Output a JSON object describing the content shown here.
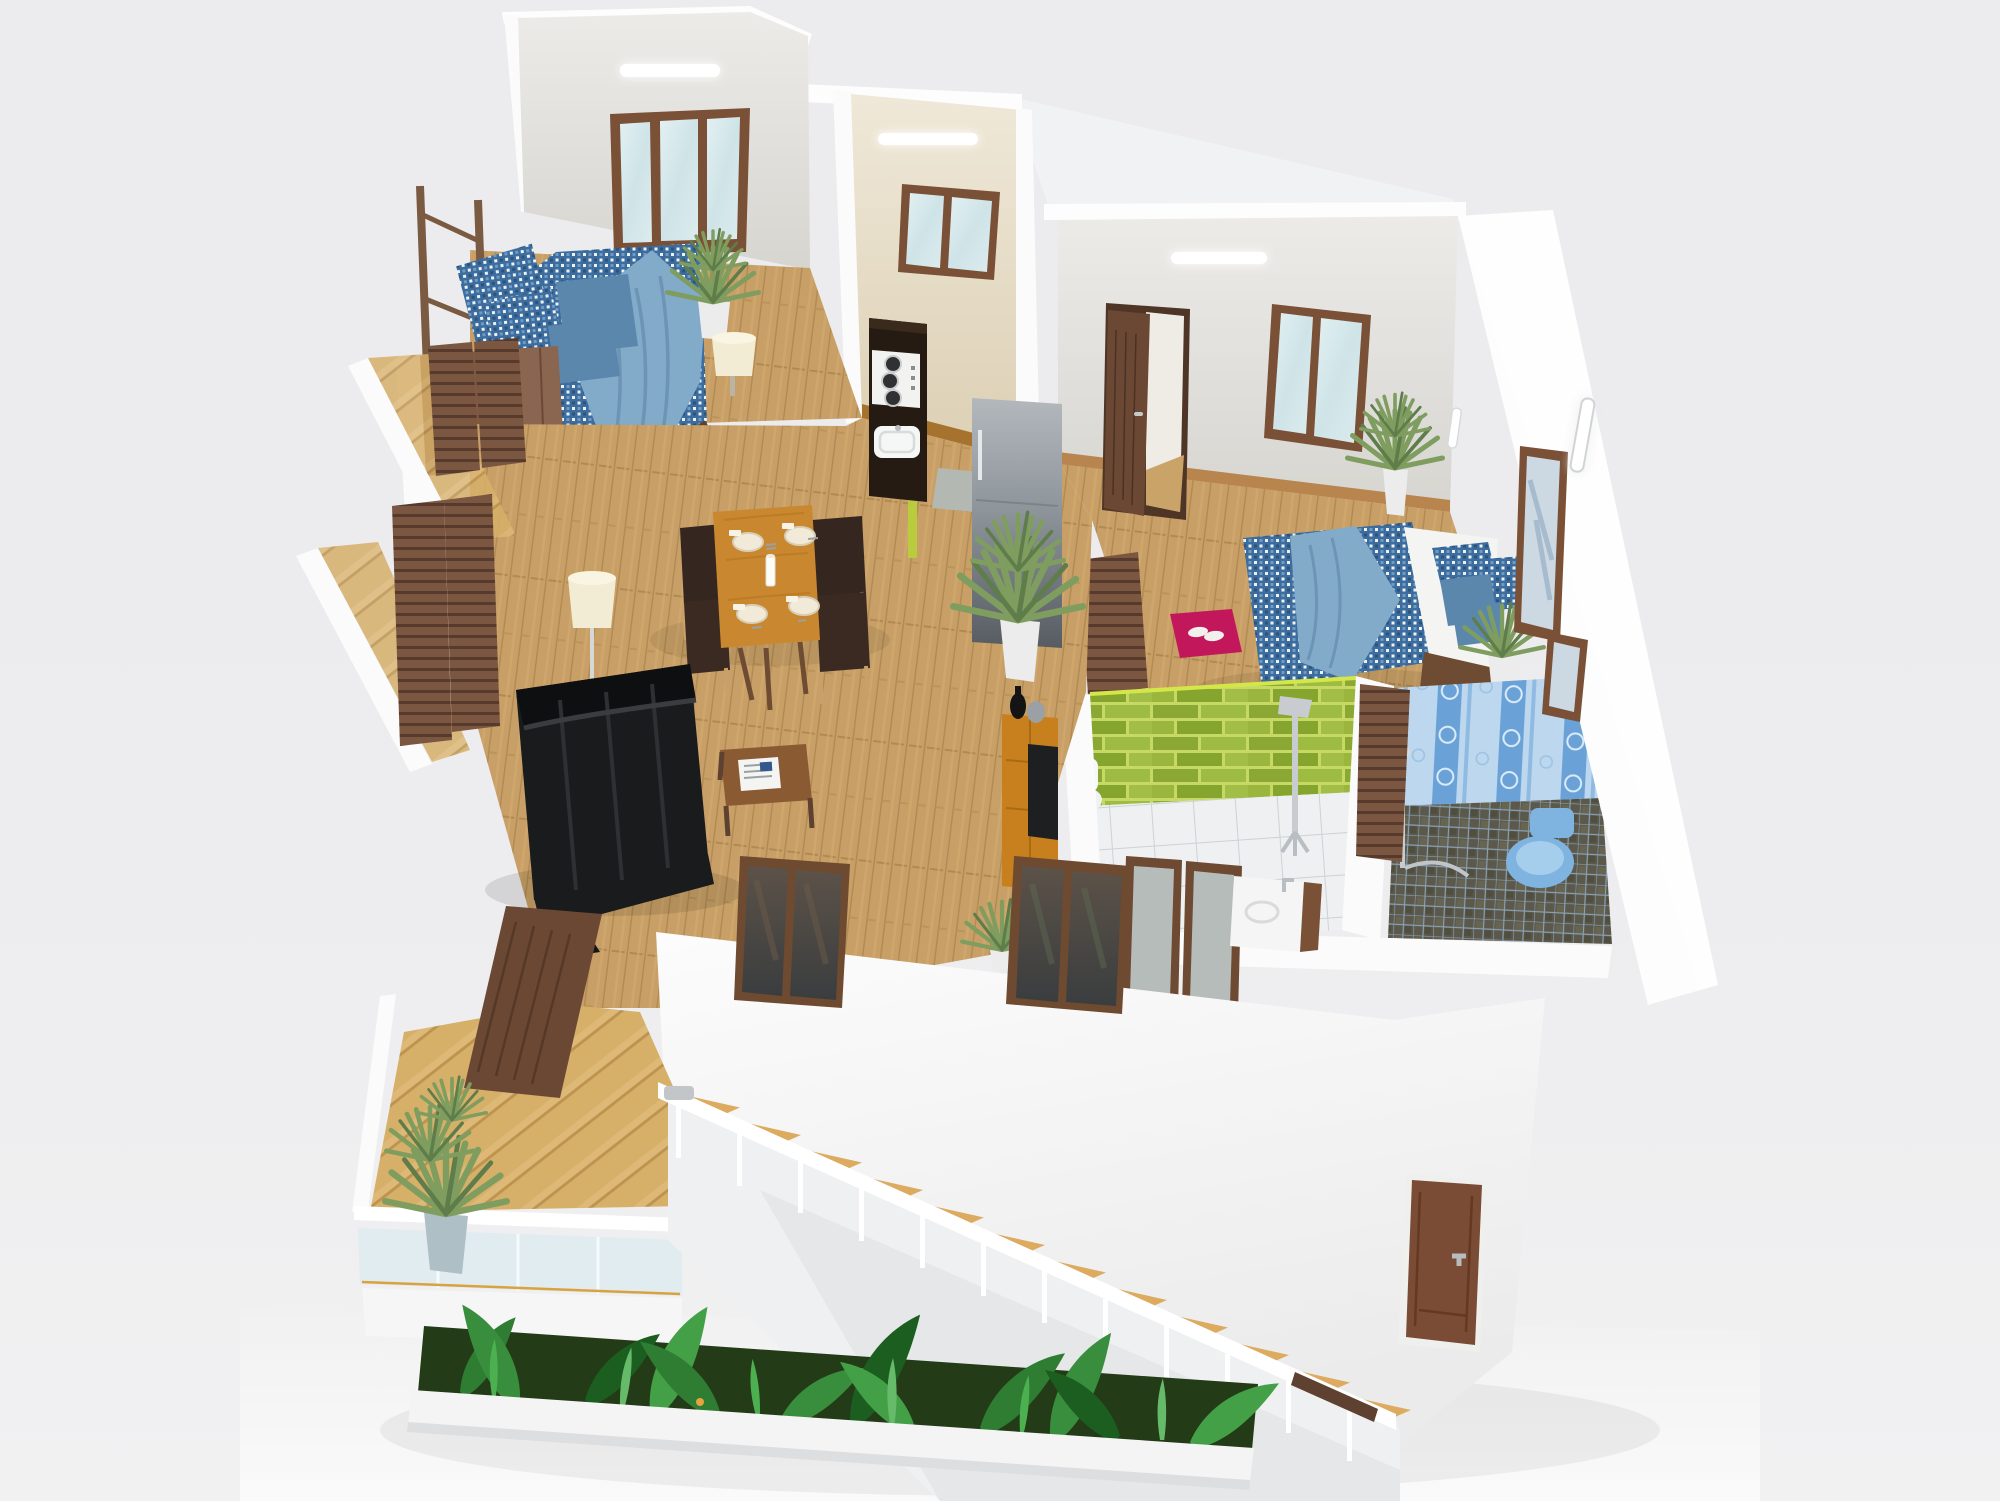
{
  "scene": {
    "type": "3d-isometric-floor-plan-render",
    "description": "Cutaway 3D rendering of a two-bedroom apartment viewed from above at an angle, with an exterior staircase and planter garden below the terrace",
    "view": "isometric cutaway from upper left",
    "visible_text": "none"
  },
  "palette": {
    "background": "#ededef",
    "ground": "#f7f7f8",
    "wall_white": "#fbfbfb",
    "wall_light": "#e9e8e4",
    "wall_shadow": "#d8d7d2",
    "wall_warm": "#e9e2cf",
    "wood_frame": "#7a5136",
    "door_interior": "#6b4833",
    "door_entry": "#7a4b35",
    "wood_dark": "#5e4130",
    "partition_brown": "#7b5640",
    "floor_wood": "#c8a067",
    "floor_parquet": "#d9b46f",
    "stair_wood": "#dcab60",
    "glass_light": "#d6e9ee",
    "glass_dark": "#474a4c",
    "bed_blue": "#3c6d9e",
    "bed_blue_light": "#82aac9",
    "pillow_blue": "#5b87ad",
    "mattress_white": "#f4f4f2",
    "green_tile": "#93b13a",
    "green_tile_edge": "#d4e74a",
    "bath_floor_white": "#eef0f1",
    "blue_tile_light": "#bcd7ee",
    "blue_tile_stripe": "#6aa2d8",
    "mosaic_dark": "#5b594b",
    "toilet_blue": "#7fb3e0",
    "rug_magenta": "#c2185b",
    "rug_purple": "#38293c",
    "sofa_black": "#1a1b1d",
    "console_orange": "#c8801f",
    "table_wood": "#c9882f",
    "lamp_cream": "#f3ecd4",
    "plant_green": "#7f9d5f",
    "foliage_dark": "#2e7d32",
    "chrome": "#c8ccd0",
    "counter_dark": "#261b12",
    "fridge_gray": "#9aa0a6",
    "light_white": "#ffffff"
  },
  "counts": {
    "dining_chairs": 4,
    "place_settings": 4,
    "gas_burners": 3,
    "stair_treads": 12,
    "stair_balusters": 12,
    "windows_visible": 7,
    "ceiling_strip_lights": 3
  },
  "rooms": [
    {
      "id": "bedroom-1",
      "label": "Bedroom 1 (upper left)",
      "objects": [
        "double bed with blue patterned duvet and light blue throw",
        "blue pillows",
        "potted plant in white vase",
        "cream table lamp",
        "dark purple rug",
        "wooden wardrobe bench",
        "triple-pane wooden window",
        "ceiling strip light",
        "wooden balcony railing"
      ]
    },
    {
      "id": "kitchen",
      "label": "Kitchen (center top)",
      "objects": [
        "dark counter with 3-burner gas hob",
        "white kitchen sink",
        "stainless refrigerator",
        "double-pane wooden window",
        "ceiling strip light",
        "tall palm plant in white pot",
        "gray doormat"
      ]
    },
    {
      "id": "bedroom-2",
      "label": "Bedroom 2 (right)",
      "objects": [
        "double bed with white mattress and blue duvet",
        "blue pillows",
        "open wooden interior door",
        "tilted double-pane window",
        "magenta rug with white slippers",
        "corner plant in tall white vase",
        "bedside plant",
        "wooden partitions",
        "framed wall panels",
        "wall tube light",
        "ceiling strip light"
      ]
    },
    {
      "id": "shower-room-green",
      "label": "Green tiled shower room",
      "objects": [
        "lime green brick tile walls",
        "white tiled floor",
        "chrome shower column",
        "white toilet",
        "framed glass doors"
      ]
    },
    {
      "id": "bathroom-blue",
      "label": "Blue bathroom",
      "objects": [
        "blue patterned tile walls",
        "dark mosaic tile floor",
        "wall-hung blue toilet",
        "chrome shower set",
        "white sink counter with faucet"
      ]
    },
    {
      "id": "living-room",
      "label": "Living room",
      "objects": [
        "black leather sofa",
        "wooden coffee table with newspaper",
        "cream tripod floor lamp",
        "orange wood TV sideboard",
        "flat TV",
        "decorative vases",
        "potted plant",
        "wooden slat screens"
      ]
    },
    {
      "id": "dining-area",
      "label": "Dining area",
      "objects": [
        "wooden dining table set for four",
        "four plates with cutlery and napkins",
        "white candle",
        "four dark wooden chairs"
      ]
    },
    {
      "id": "balcony-terrace",
      "label": "Balcony terrace (lower left)",
      "objects": [
        "herringbone parquet floor",
        "glass railing with white frame",
        "two yucca plants in pots",
        "open wooden balcony door"
      ]
    },
    {
      "id": "staircase",
      "label": "Exterior staircase",
      "objects": [
        "wooden treads",
        "white railing with balusters",
        "brown handrail accent"
      ]
    },
    {
      "id": "garden-planter",
      "label": "Garden planter strip",
      "objects": [
        "tropical banana leaves",
        "grasses",
        "small yellow and orange flowers",
        "white planter ledge"
      ]
    },
    {
      "id": "exterior",
      "label": "Exterior shell",
      "objects": [
        "white front wall",
        "two dark-glass front windows",
        "brown entry door with metal handle",
        "tall white side wall",
        "white roof caps"
      ]
    }
  ]
}
